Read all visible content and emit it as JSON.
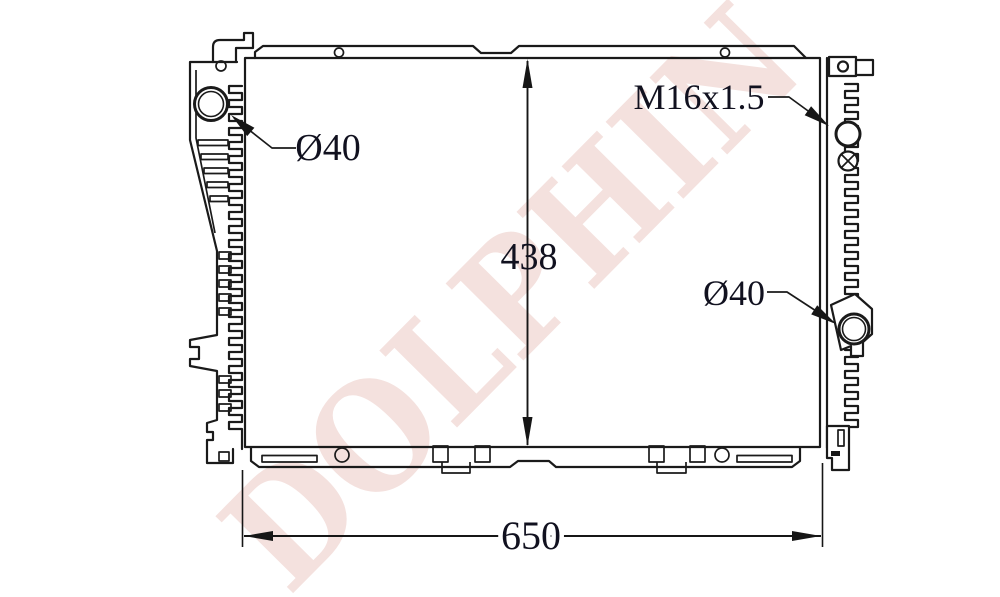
{
  "diagram": {
    "watermark": "DOLPHIN",
    "labels": {
      "left_port_diameter": "Ø40",
      "filler_thread": "M16x1.5",
      "right_port_diameter": "Ø40"
    },
    "dimensions": {
      "core_height": "438",
      "overall_width": "650"
    },
    "colors": {
      "ink": "#1a1a1a",
      "dimension_text": "#11111f",
      "watermark": "#f4e1de",
      "background": "#ffffff"
    }
  }
}
